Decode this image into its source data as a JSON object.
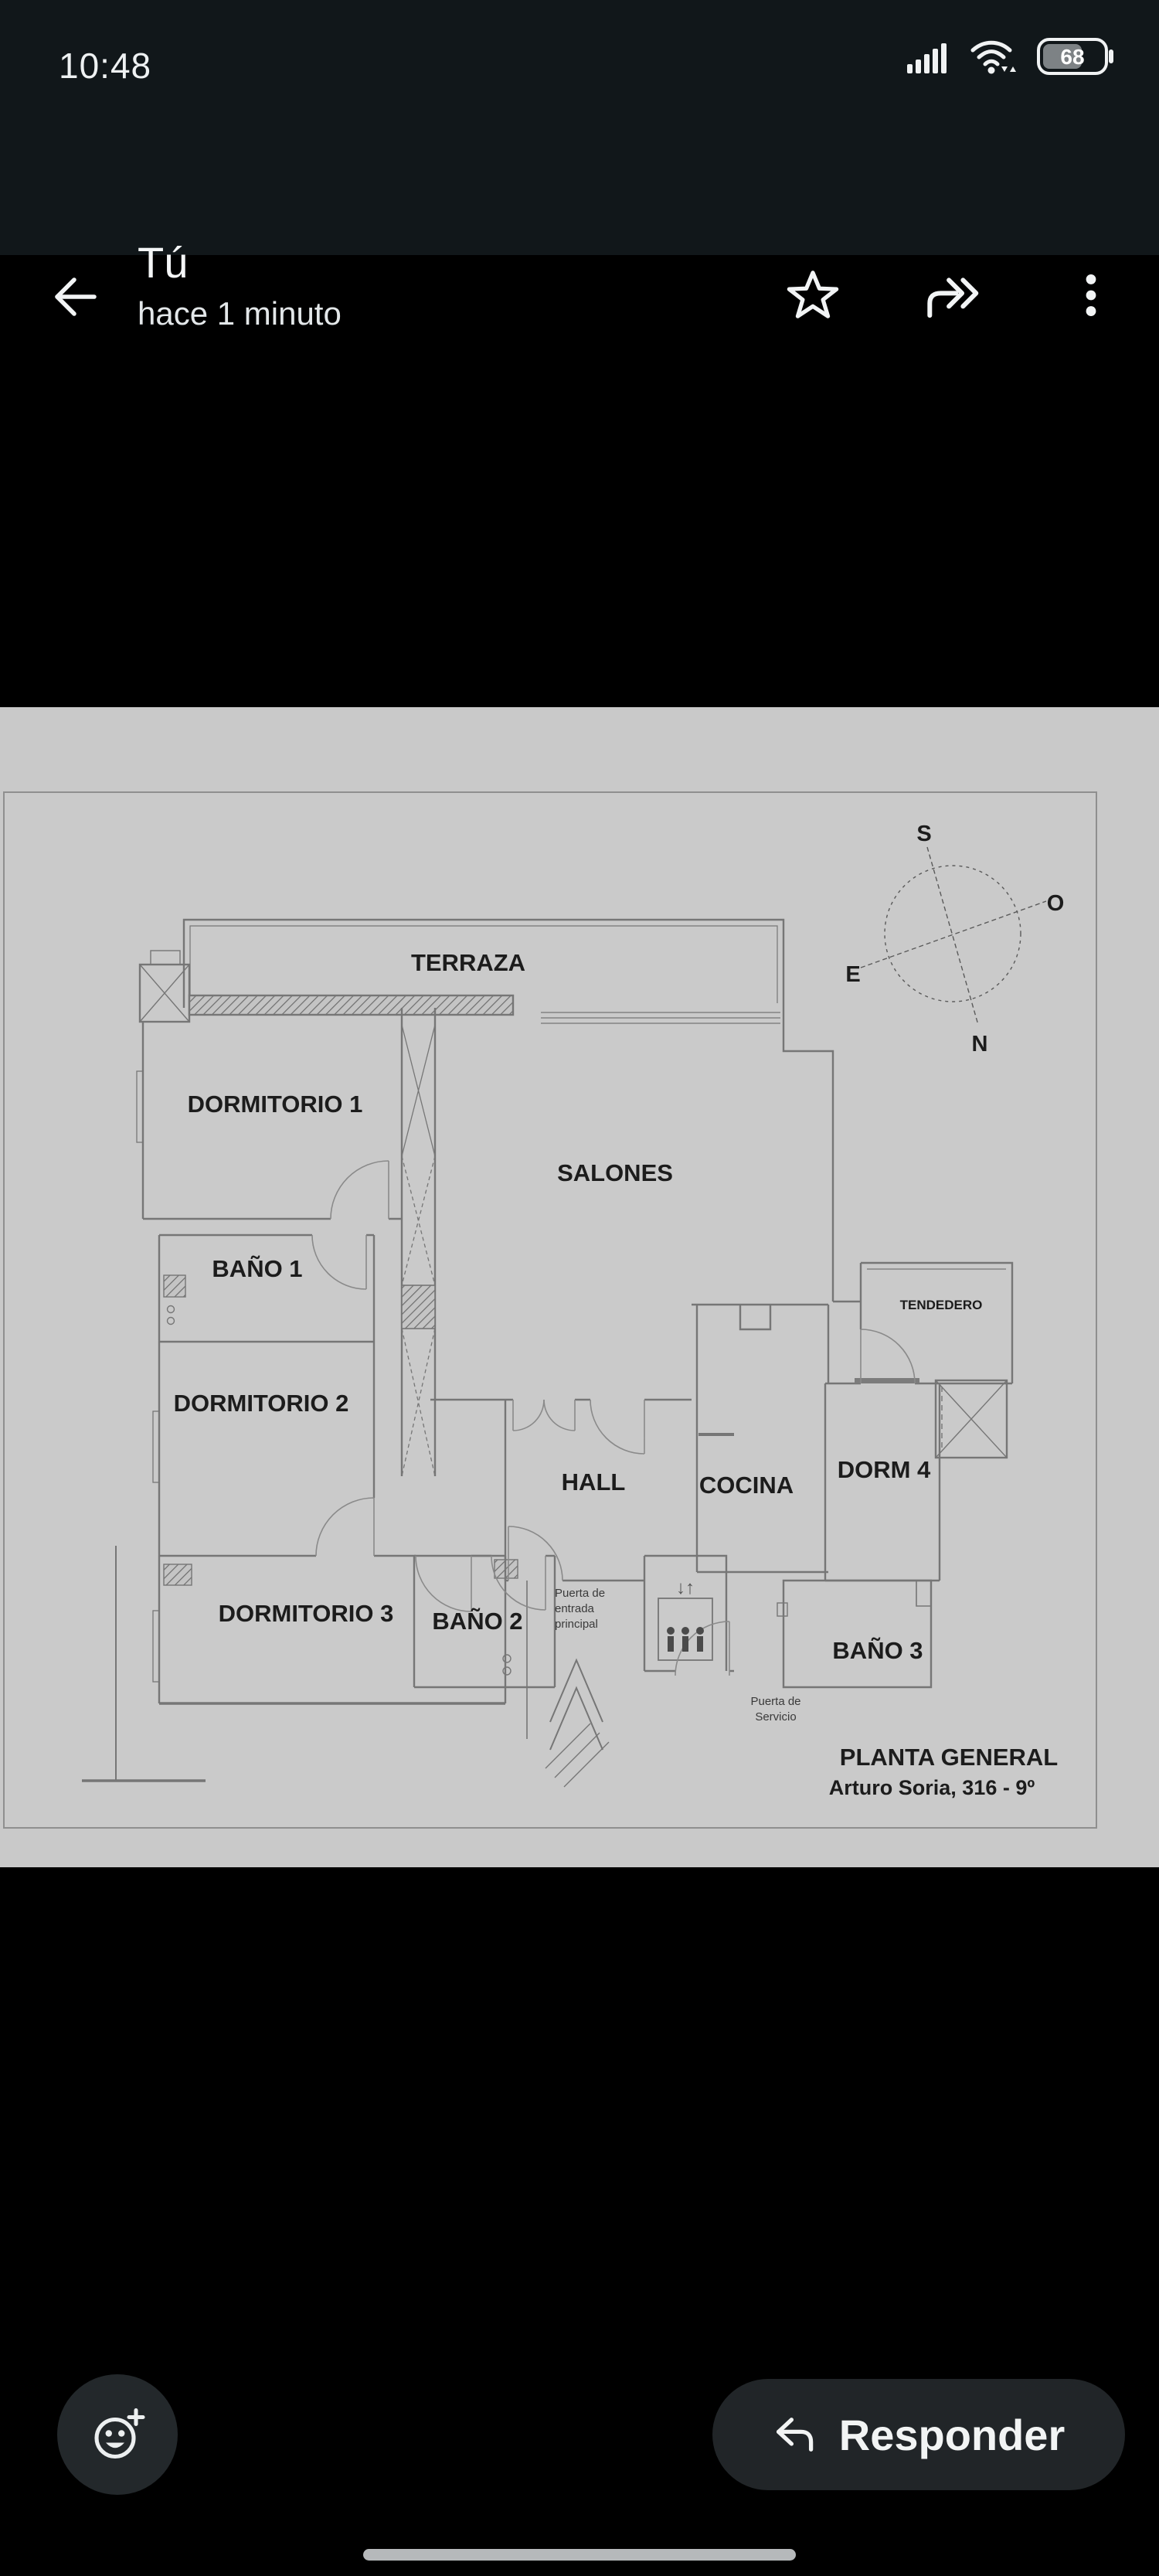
{
  "status_bar": {
    "time": "10:48",
    "battery": "68"
  },
  "header": {
    "title": "Tú",
    "subtitle": "hace 1 minuto"
  },
  "plan": {
    "rooms": {
      "terraza": "TERRAZA",
      "dorm1": "DORMITORIO 1",
      "salones": "SALONES",
      "bano1": "BAÑO 1",
      "dorm2": "DORMITORIO 2",
      "dorm3": "DORMITORIO 3",
      "bano2": "BAÑO 2",
      "hall": "HALL",
      "cocina": "COCINA",
      "dorm4": "DORM 4",
      "tendedero": "TENDEDERO",
      "bano3": "BAÑO 3"
    },
    "compass": {
      "s": "S",
      "o": "O",
      "e": "E",
      "n": "N"
    },
    "entrance_note_l1": "Puerta de",
    "entrance_note_l2": "entrada",
    "entrance_note_l3": "principal",
    "service_note_l1": "Puerta de",
    "service_note_l2": "Servicio",
    "elevator_arrows": "↓↑",
    "title": "PLANTA GENERAL",
    "subtitle": "Arturo Soria, 316 - 9º"
  },
  "footer": {
    "reply": "Responder"
  },
  "colors": {
    "chrome_bg": "#11171a",
    "photo_bg": "#c9c9c9",
    "button_bg": "#212528",
    "wall": "#757575"
  }
}
